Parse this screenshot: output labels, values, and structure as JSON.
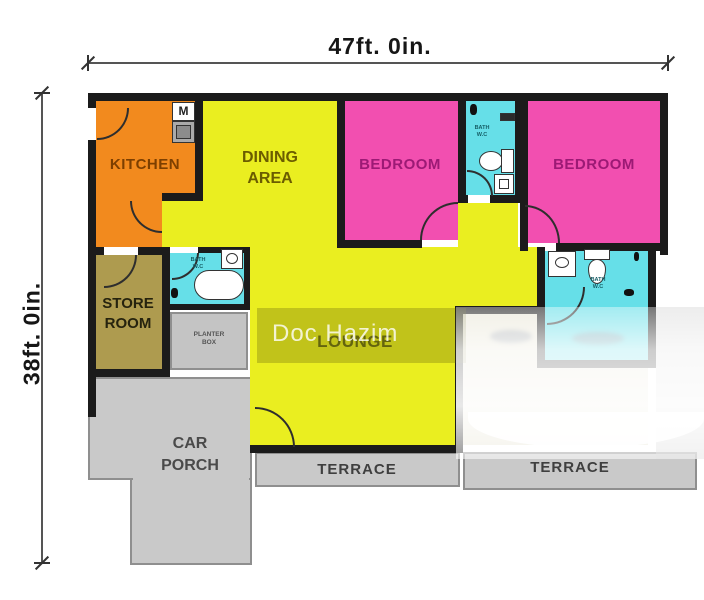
{
  "dimensions": {
    "width_label": "47ft. 0in.",
    "height_label": "38ft. 0in."
  },
  "rooms": {
    "kitchen": "KITCHEN",
    "dining": "DINING\nAREA",
    "bedroom_left": "BEDROOM",
    "bedroom_right": "BEDROOM",
    "store": "STORE\nROOM",
    "lounge": "LOUNGE",
    "car_porch": "CAR\nPORCH",
    "terrace_left": "TERRACE",
    "terrace_right": "TERRACE",
    "planter": "PLANTER\nBOX",
    "bath_top": "BATH\nW.C",
    "bath_left": "BATH\nW.C",
    "bath_right": "BATH\nW.C",
    "kitchen_appliance_glyph": "M"
  },
  "watermark": "Doc Hazim",
  "colors": {
    "kitchen": "#F28A1E",
    "dining_lounge": "#EAEE20",
    "bedroom": "#F24FB0",
    "bath": "#66DFE8",
    "store": "#AE9B4F",
    "paving": "#C9C9C9",
    "planter": "#C4C4C4",
    "washed_floor": "#E9E6D6",
    "wall": "#1B1B1B"
  }
}
